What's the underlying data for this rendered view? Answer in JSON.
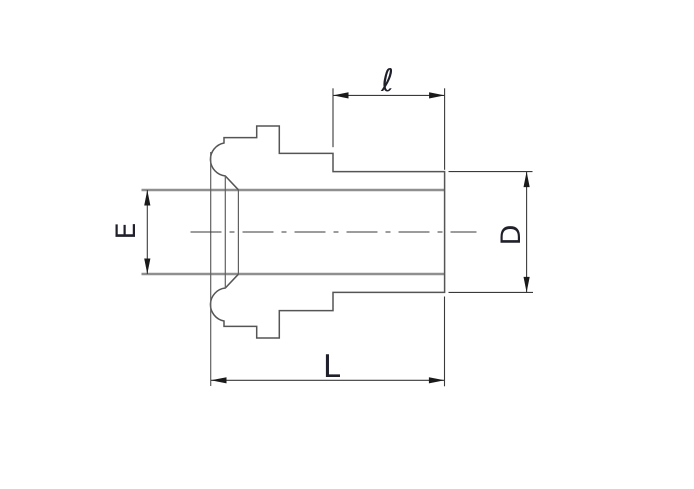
{
  "diagram": {
    "kind": "technical-drawing",
    "view": "side profile of tube fitting with weld bead nose, stepped body and plain cylindrical end",
    "colors": {
      "background": "#ffffff",
      "part_outline": "#555555",
      "bore_edge": "#8f8f8f",
      "dimension_lines": "#3a3a3a",
      "arrowheads": "#1a1a1a",
      "label_text": "#20202b"
    }
  },
  "dimensions": [
    {
      "id": "ell",
      "label": "ℓ",
      "orientation": "horizontal",
      "position": "top"
    },
    {
      "id": "E",
      "label": "E",
      "orientation": "vertical",
      "position": "left"
    },
    {
      "id": "D",
      "label": "D",
      "orientation": "vertical",
      "position": "right"
    },
    {
      "id": "L",
      "label": "L",
      "orientation": "horizontal",
      "position": "bottom"
    }
  ]
}
